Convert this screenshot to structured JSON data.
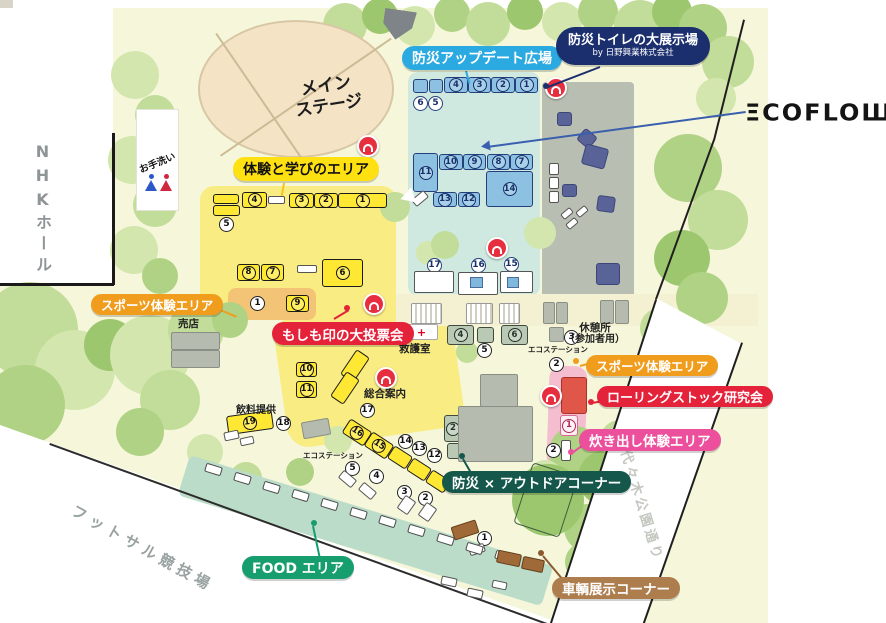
{
  "brand": {
    "name": "ECOFLOW",
    "display": "ΞCOFLOШ"
  },
  "badges": {
    "update_plaza": "防災アップデート広場",
    "toilet_expo_line1": "防災トイレの大展示場",
    "toilet_expo_line2": "by 日野興業株式会社",
    "learning_area": "体験と学びのエリア",
    "sports_area_left": "スポーツ体験エリア",
    "sports_area_right": "スポーツ体験エリア",
    "voting": "もしも印の大投票会",
    "rolling_stock": "ローリングストック研究会",
    "cooking": "炊き出し体験エリア",
    "outdoor": "防災 × アウトドアコーナー",
    "food": "FOOD エリア",
    "vehicle": "車輌展示コーナー"
  },
  "labels": {
    "stage_l1": "メイン",
    "stage_l2": "ステージ",
    "nhk_hall": "NHKホール",
    "restroom": "お手洗い",
    "shop": "売店",
    "first_aid": "救護室",
    "first_aid_cross": "+",
    "eco_station_mid": "エコステーション",
    "eco_station_south": "エコステーション",
    "rest_area_line1": "休憩所",
    "rest_area_line2": "（参加者用）",
    "info_desk": "総合案内",
    "drinks": "飲料提供",
    "futsal": "フットサル競技場",
    "yoyogi_street": "代々木公園通り"
  },
  "tree_palette": [
    "#d3e6ae",
    "#c2dc99",
    "#b0d285",
    "#9dc76f",
    "#8cbc5e"
  ],
  "trees": [
    [
      345,
      25,
      22,
      1
    ],
    [
      380,
      16,
      18,
      3
    ],
    [
      415,
      26,
      20,
      0
    ],
    [
      452,
      14,
      18,
      2
    ],
    [
      488,
      24,
      22,
      1
    ],
    [
      525,
      12,
      18,
      3
    ],
    [
      562,
      22,
      20,
      0
    ],
    [
      598,
      12,
      20,
      2
    ],
    [
      640,
      26,
      26,
      1
    ],
    [
      672,
      12,
      20,
      3
    ],
    [
      703,
      28,
      24,
      2
    ],
    [
      728,
      62,
      26,
      1
    ],
    [
      716,
      98,
      20,
      0
    ],
    [
      688,
      168,
      34,
      2
    ],
    [
      718,
      220,
      30,
      1
    ],
    [
      682,
      258,
      28,
      3
    ],
    [
      702,
      298,
      26,
      2
    ],
    [
      660,
      328,
      20,
      1
    ],
    [
      135,
      75,
      24,
      0
    ],
    [
      155,
      115,
      20,
      1
    ],
    [
      132,
      160,
      24,
      0
    ],
    [
      155,
      205,
      22,
      1
    ],
    [
      134,
      250,
      24,
      0
    ],
    [
      160,
      276,
      18,
      2
    ],
    [
      30,
      330,
      48,
      1
    ],
    [
      75,
      370,
      40,
      0
    ],
    [
      25,
      405,
      40,
      2
    ],
    [
      110,
      345,
      26,
      3
    ],
    [
      150,
      355,
      40,
      0
    ],
    [
      196,
      330,
      28,
      1
    ],
    [
      230,
      320,
      18,
      2
    ],
    [
      170,
      400,
      30,
      1
    ],
    [
      140,
      432,
      24,
      2
    ],
    [
      205,
      452,
      18,
      0
    ],
    [
      246,
      478,
      16,
      1
    ],
    [
      300,
      472,
      14,
      2
    ],
    [
      338,
      440,
      14,
      0
    ],
    [
      395,
      207,
      15,
      1
    ],
    [
      540,
      233,
      16,
      0
    ],
    [
      428,
      253,
      12,
      0
    ],
    [
      445,
      245,
      14,
      1
    ],
    [
      467,
      352,
      11,
      1
    ],
    [
      575,
      452,
      26,
      2
    ],
    [
      606,
      478,
      28,
      3
    ],
    [
      558,
      498,
      22,
      1
    ],
    [
      588,
      528,
      24,
      2
    ],
    [
      545,
      478,
      18,
      0
    ],
    [
      585,
      562,
      20,
      2
    ],
    [
      548,
      500,
      36,
      3
    ],
    [
      620,
      440,
      20,
      1
    ]
  ],
  "markers": [
    {
      "n": "4",
      "k": "yb",
      "x": 242,
      "y": 192,
      "w": 25,
      "h": 16
    },
    {
      "n": "3",
      "k": "yb",
      "x": 289,
      "y": 193,
      "w": 25,
      "h": 15
    },
    {
      "n": "2",
      "k": "yb",
      "x": 314,
      "y": 193,
      "w": 24,
      "h": 15
    },
    {
      "n": "1",
      "k": "yb",
      "x": 338,
      "y": 193,
      "w": 49,
      "h": 15
    },
    {
      "n": "8",
      "k": "yb",
      "x": 237,
      "y": 264,
      "w": 23,
      "h": 17
    },
    {
      "n": "7",
      "k": "yb",
      "x": 261,
      "y": 264,
      "w": 23,
      "h": 17
    },
    {
      "n": "6",
      "k": "yb",
      "x": 322,
      "y": 259,
      "w": 41,
      "h": 28
    },
    {
      "n": "9",
      "k": "yb",
      "x": 286,
      "y": 295,
      "w": 23,
      "h": 17
    },
    {
      "n": "10",
      "k": "yb",
      "x": 296,
      "y": 362,
      "w": 21,
      "h": 15
    },
    {
      "n": "11",
      "k": "yb",
      "x": 296,
      "y": 381,
      "w": 21,
      "h": 17
    },
    {
      "n": "19",
      "k": "yb",
      "x": 227,
      "y": 413,
      "w": 46,
      "h": 19,
      "r": -8
    },
    {
      "n": "16",
      "k": "yb",
      "x": 344,
      "y": 424,
      "w": 26,
      "h": 17,
      "r": 33
    },
    {
      "n": "15",
      "k": "yb",
      "x": 366,
      "y": 437,
      "w": 26,
      "h": 17,
      "r": 33
    },
    {
      "k": "yb",
      "x": 213,
      "y": 194,
      "w": 26,
      "h": 10
    },
    {
      "k": "yb",
      "x": 213,
      "y": 205,
      "w": 27,
      "h": 11
    },
    {
      "k": "yb",
      "x": 340,
      "y": 358,
      "w": 30,
      "h": 16,
      "r": -56
    },
    {
      "k": "yb",
      "x": 330,
      "y": 380,
      "w": 30,
      "h": 16,
      "r": -56
    },
    {
      "k": "yb",
      "x": 389,
      "y": 450,
      "w": 22,
      "h": 15,
      "r": 33
    },
    {
      "k": "yb",
      "x": 408,
      "y": 462,
      "w": 22,
      "h": 15,
      "r": 33
    },
    {
      "k": "yb",
      "x": 427,
      "y": 474,
      "w": 22,
      "h": 15,
      "r": 33
    },
    {
      "n": "4",
      "k": "bb",
      "x": 444,
      "y": 77,
      "w": 24,
      "h": 16
    },
    {
      "n": "3",
      "k": "bb",
      "x": 468,
      "y": 77,
      "w": 23,
      "h": 16
    },
    {
      "n": "2",
      "k": "bb",
      "x": 491,
      "y": 77,
      "w": 24,
      "h": 16
    },
    {
      "n": "1",
      "k": "bb",
      "x": 515,
      "y": 77,
      "w": 23,
      "h": 16
    },
    {
      "n": "11",
      "k": "bb",
      "x": 413,
      "y": 153,
      "w": 25,
      "h": 39
    },
    {
      "n": "10",
      "k": "bb",
      "x": 439,
      "y": 154,
      "w": 24,
      "h": 16
    },
    {
      "n": "9",
      "k": "bb",
      "x": 463,
      "y": 154,
      "w": 23,
      "h": 16
    },
    {
      "n": "8",
      "k": "bb",
      "x": 487,
      "y": 154,
      "w": 23,
      "h": 16
    },
    {
      "n": "7",
      "k": "bb",
      "x": 510,
      "y": 154,
      "w": 23,
      "h": 16
    },
    {
      "n": "14",
      "k": "bb",
      "x": 486,
      "y": 171,
      "w": 47,
      "h": 36
    },
    {
      "n": "13",
      "k": "bb",
      "x": 433,
      "y": 192,
      "w": 24,
      "h": 15
    },
    {
      "n": "12",
      "k": "bb",
      "x": 458,
      "y": 192,
      "w": 22,
      "h": 15
    },
    {
      "k": "bb",
      "x": 413,
      "y": 79,
      "w": 15,
      "h": 14
    },
    {
      "k": "bb",
      "x": 429,
      "y": 79,
      "w": 14,
      "h": 14
    },
    {
      "n": "5",
      "k": "c",
      "x": 219,
      "y": 217
    },
    {
      "n": "1",
      "k": "c",
      "x": 250,
      "y": 296
    },
    {
      "n": "17",
      "k": "c",
      "x": 360,
      "y": 403
    },
    {
      "n": "18",
      "k": "c",
      "x": 276,
      "y": 416
    },
    {
      "n": "14",
      "k": "c",
      "x": 398,
      "y": 434
    },
    {
      "n": "13",
      "k": "c",
      "x": 412,
      "y": 441
    },
    {
      "n": "12",
      "k": "c",
      "x": 427,
      "y": 448
    },
    {
      "n": "5",
      "k": "c",
      "x": 345,
      "y": 461
    },
    {
      "n": "4",
      "k": "c",
      "x": 369,
      "y": 469
    },
    {
      "n": "3",
      "k": "c",
      "x": 397,
      "y": 485
    },
    {
      "n": "2",
      "k": "c",
      "x": 418,
      "y": 491
    },
    {
      "n": "1",
      "k": "c",
      "x": 477,
      "y": 531
    },
    {
      "n": "3",
      "k": "c",
      "x": 564,
      "y": 330
    },
    {
      "n": "2",
      "k": "c",
      "x": 549,
      "y": 357
    },
    {
      "n": "5",
      "k": "c",
      "x": 477,
      "y": 343
    },
    {
      "n": "1",
      "k": "c",
      "x": 462,
      "y": 447
    },
    {
      "n": "2",
      "k": "c",
      "x": 546,
      "y": 443
    },
    {
      "n": "6",
      "k": "bc",
      "x": 413,
      "y": 96
    },
    {
      "n": "5",
      "k": "bc",
      "x": 428,
      "y": 96
    },
    {
      "n": "17",
      "k": "bc",
      "x": 427,
      "y": 258
    },
    {
      "n": "16",
      "k": "bc",
      "x": 471,
      "y": 258
    },
    {
      "n": "15",
      "k": "bc",
      "x": 504,
      "y": 257
    },
    {
      "n": "4",
      "k": "sb",
      "x": 447,
      "y": 325,
      "w": 27,
      "h": 20
    },
    {
      "n": "6",
      "k": "sb",
      "x": 501,
      "y": 325,
      "w": 27,
      "h": 20
    },
    {
      "n": "3",
      "k": "sb",
      "x": 494,
      "y": 389,
      "w": 24,
      "h": 18
    },
    {
      "n": "2",
      "k": "sb",
      "x": 444,
      "y": 415,
      "w": 18,
      "h": 27
    },
    {
      "k": "sb",
      "x": 477,
      "y": 327,
      "w": 17,
      "h": 16
    },
    {
      "k": "sb",
      "x": 447,
      "y": 443,
      "w": 14,
      "h": 16
    },
    {
      "n": "1",
      "k": "pb",
      "x": 560,
      "y": 415,
      "w": 18,
      "h": 21
    },
    {
      "k": "rb",
      "x": 561,
      "y": 377,
      "w": 26,
      "h": 37
    },
    {
      "k": "wb",
      "x": 268,
      "y": 196,
      "w": 17,
      "h": 8
    },
    {
      "k": "wb",
      "x": 297,
      "y": 265,
      "w": 20,
      "h": 8
    },
    {
      "k": "wb",
      "x": 561,
      "y": 440,
      "w": 10,
      "h": 21
    },
    {
      "k": "wb",
      "x": 414,
      "y": 271,
      "w": 40,
      "h": 22
    },
    {
      "k": "wb",
      "x": 458,
      "y": 272,
      "w": 40,
      "h": 23
    },
    {
      "k": "wb",
      "x": 500,
      "y": 271,
      "w": 33,
      "h": 22
    },
    {
      "k": "wb",
      "x": 549,
      "y": 163,
      "w": 10,
      "h": 12
    },
    {
      "k": "wb",
      "x": 549,
      "y": 177,
      "w": 10,
      "h": 12
    },
    {
      "k": "wb",
      "x": 549,
      "y": 191,
      "w": 10,
      "h": 12
    },
    {
      "k": "wb",
      "x": 561,
      "y": 210,
      "w": 12,
      "h": 7,
      "r": -40
    },
    {
      "k": "wb",
      "x": 576,
      "y": 208,
      "w": 12,
      "h": 7,
      "r": -40
    },
    {
      "k": "wb",
      "x": 566,
      "y": 220,
      "w": 12,
      "h": 7,
      "r": -40
    },
    {
      "k": "wb",
      "x": 412,
      "y": 194,
      "w": 16,
      "h": 9,
      "r": -40
    },
    {
      "k": "wb",
      "x": 469,
      "y": 545,
      "w": 16,
      "h": 9,
      "r": -18
    },
    {
      "k": "wb",
      "x": 441,
      "y": 577,
      "w": 16,
      "h": 9,
      "r": 12
    },
    {
      "k": "wb",
      "x": 467,
      "y": 589,
      "w": 16,
      "h": 9,
      "r": 12
    },
    {
      "k": "wb",
      "x": 492,
      "y": 581,
      "w": 15,
      "h": 8,
      "r": 12
    },
    {
      "k": "wb",
      "x": 339,
      "y": 474,
      "w": 17,
      "h": 10,
      "r": 40
    },
    {
      "k": "wb",
      "x": 359,
      "y": 486,
      "w": 17,
      "h": 10,
      "r": 40
    },
    {
      "k": "wb",
      "x": 400,
      "y": 497,
      "w": 13,
      "h": 16,
      "r": 35
    },
    {
      "k": "wb",
      "x": 421,
      "y": 504,
      "w": 13,
      "h": 16,
      "r": 35
    },
    {
      "k": "wb",
      "x": 224,
      "y": 431,
      "w": 15,
      "h": 9,
      "r": -12
    },
    {
      "k": "wb",
      "x": 240,
      "y": 437,
      "w": 14,
      "h": 8,
      "r": -12
    },
    {
      "k": "bsq",
      "x": 470,
      "y": 277,
      "w": 13,
      "h": 11
    },
    {
      "k": "bsq",
      "x": 507,
      "y": 277,
      "w": 12,
      "h": 11
    },
    {
      "k": "gb",
      "x": 549,
      "y": 327,
      "w": 15,
      "h": 15
    },
    {
      "k": "gb",
      "x": 543,
      "y": 302,
      "w": 12,
      "h": 22
    },
    {
      "k": "gb",
      "x": 556,
      "y": 302,
      "w": 12,
      "h": 22
    },
    {
      "k": "gb",
      "x": 600,
      "y": 300,
      "w": 14,
      "h": 24
    },
    {
      "k": "gb",
      "x": 615,
      "y": 300,
      "w": 14,
      "h": 24
    },
    {
      "k": "gb",
      "x": 302,
      "y": 420,
      "w": 28,
      "h": 17,
      "r": -10
    },
    {
      "k": "gb",
      "x": 171,
      "y": 332,
      "w": 49,
      "h": 18
    },
    {
      "k": "gb",
      "x": 171,
      "y": 350,
      "w": 49,
      "h": 18
    },
    {
      "k": "gb",
      "x": 480,
      "y": 374,
      "w": 38,
      "h": 33
    },
    {
      "k": "gb",
      "x": 458,
      "y": 406,
      "w": 75,
      "h": 56
    },
    {
      "k": "nv",
      "x": 557,
      "y": 112,
      "w": 15,
      "h": 14
    },
    {
      "k": "nv",
      "x": 579,
      "y": 131,
      "w": 16,
      "h": 15,
      "r": 40
    },
    {
      "k": "nv",
      "x": 583,
      "y": 146,
      "w": 24,
      "h": 21,
      "r": 15
    },
    {
      "k": "nv",
      "x": 562,
      "y": 184,
      "w": 15,
      "h": 13
    },
    {
      "k": "nv",
      "x": 597,
      "y": 196,
      "w": 18,
      "h": 16,
      "r": 8
    },
    {
      "k": "nv",
      "x": 596,
      "y": 263,
      "w": 24,
      "h": 22
    },
    {
      "k": "st",
      "x": 411,
      "y": 303,
      "w": 31,
      "h": 21
    },
    {
      "k": "st",
      "x": 466,
      "y": 303,
      "w": 27,
      "h": 21
    },
    {
      "k": "st",
      "x": 499,
      "y": 303,
      "w": 21,
      "h": 21
    },
    {
      "k": "fs",
      "x": 205,
      "y": 465,
      "r": 17
    },
    {
      "k": "fs",
      "x": 234,
      "y": 474,
      "r": 17
    },
    {
      "k": "fs",
      "x": 263,
      "y": 483,
      "r": 17
    },
    {
      "k": "fs",
      "x": 292,
      "y": 491,
      "r": 17
    },
    {
      "k": "fs",
      "x": 321,
      "y": 500,
      "r": 17
    },
    {
      "k": "fs",
      "x": 350,
      "y": 509,
      "r": 17
    },
    {
      "k": "fs",
      "x": 379,
      "y": 517,
      "r": 17
    },
    {
      "k": "fs",
      "x": 408,
      "y": 526,
      "r": 17
    },
    {
      "k": "fs",
      "x": 437,
      "y": 535,
      "r": 17
    },
    {
      "k": "fs",
      "x": 466,
      "y": 544,
      "r": 17
    },
    {
      "k": "fs",
      "x": 495,
      "y": 552,
      "r": 17
    },
    {
      "k": "fs",
      "x": 524,
      "y": 561,
      "r": 17
    },
    {
      "k": "vh",
      "x": 452,
      "y": 523,
      "w": 26,
      "h": 14,
      "r": -18
    },
    {
      "k": "vh",
      "x": 497,
      "y": 552,
      "w": 24,
      "h": 13,
      "r": 12
    },
    {
      "k": "vh",
      "x": 522,
      "y": 558,
      "w": 22,
      "h": 13,
      "r": 12
    },
    {
      "k": "ann",
      "x": 357,
      "y": 135
    },
    {
      "k": "ann",
      "x": 545,
      "y": 77
    },
    {
      "k": "ann",
      "x": 486,
      "y": 237
    },
    {
      "k": "ann",
      "x": 363,
      "y": 293
    },
    {
      "k": "ann",
      "x": 540,
      "y": 385
    },
    {
      "k": "ann",
      "x": 375,
      "y": 367
    }
  ]
}
